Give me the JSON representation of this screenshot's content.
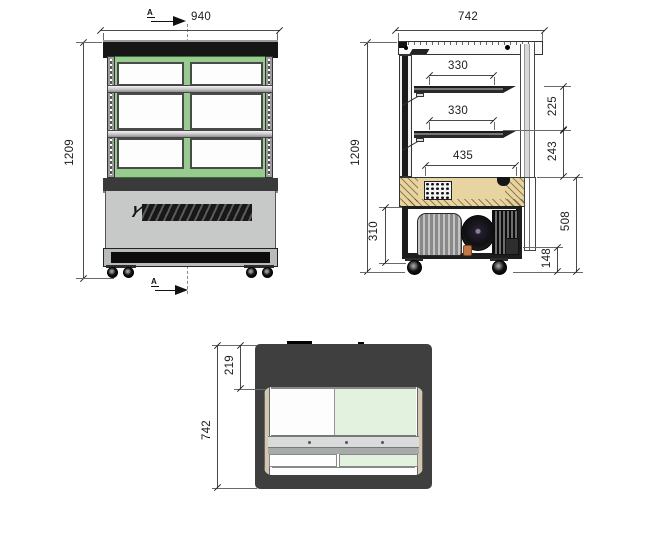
{
  "front_view": {
    "width": "940",
    "height": "1209",
    "section_letter": "A",
    "logo_mark": "Y"
  },
  "side_view": {
    "width": "742",
    "height": "1209",
    "shelf_depth_top": "330",
    "shelf_depth_middle": "330",
    "base_shelf_depth": "435",
    "gap_upper": "225",
    "gap_lower": "243",
    "machine_height": "310",
    "base_height": "508",
    "caster_height": "148"
  },
  "plan_view": {
    "rear_inset": "219",
    "depth": "742"
  },
  "colors": {
    "frame-green": "#97cc8f",
    "glass-green-tint": "#e3f1df",
    "deck-tan": "#e7d4a0",
    "panel-gray": "#c6c9c7",
    "plan-dark": "#3f3f3f"
  }
}
